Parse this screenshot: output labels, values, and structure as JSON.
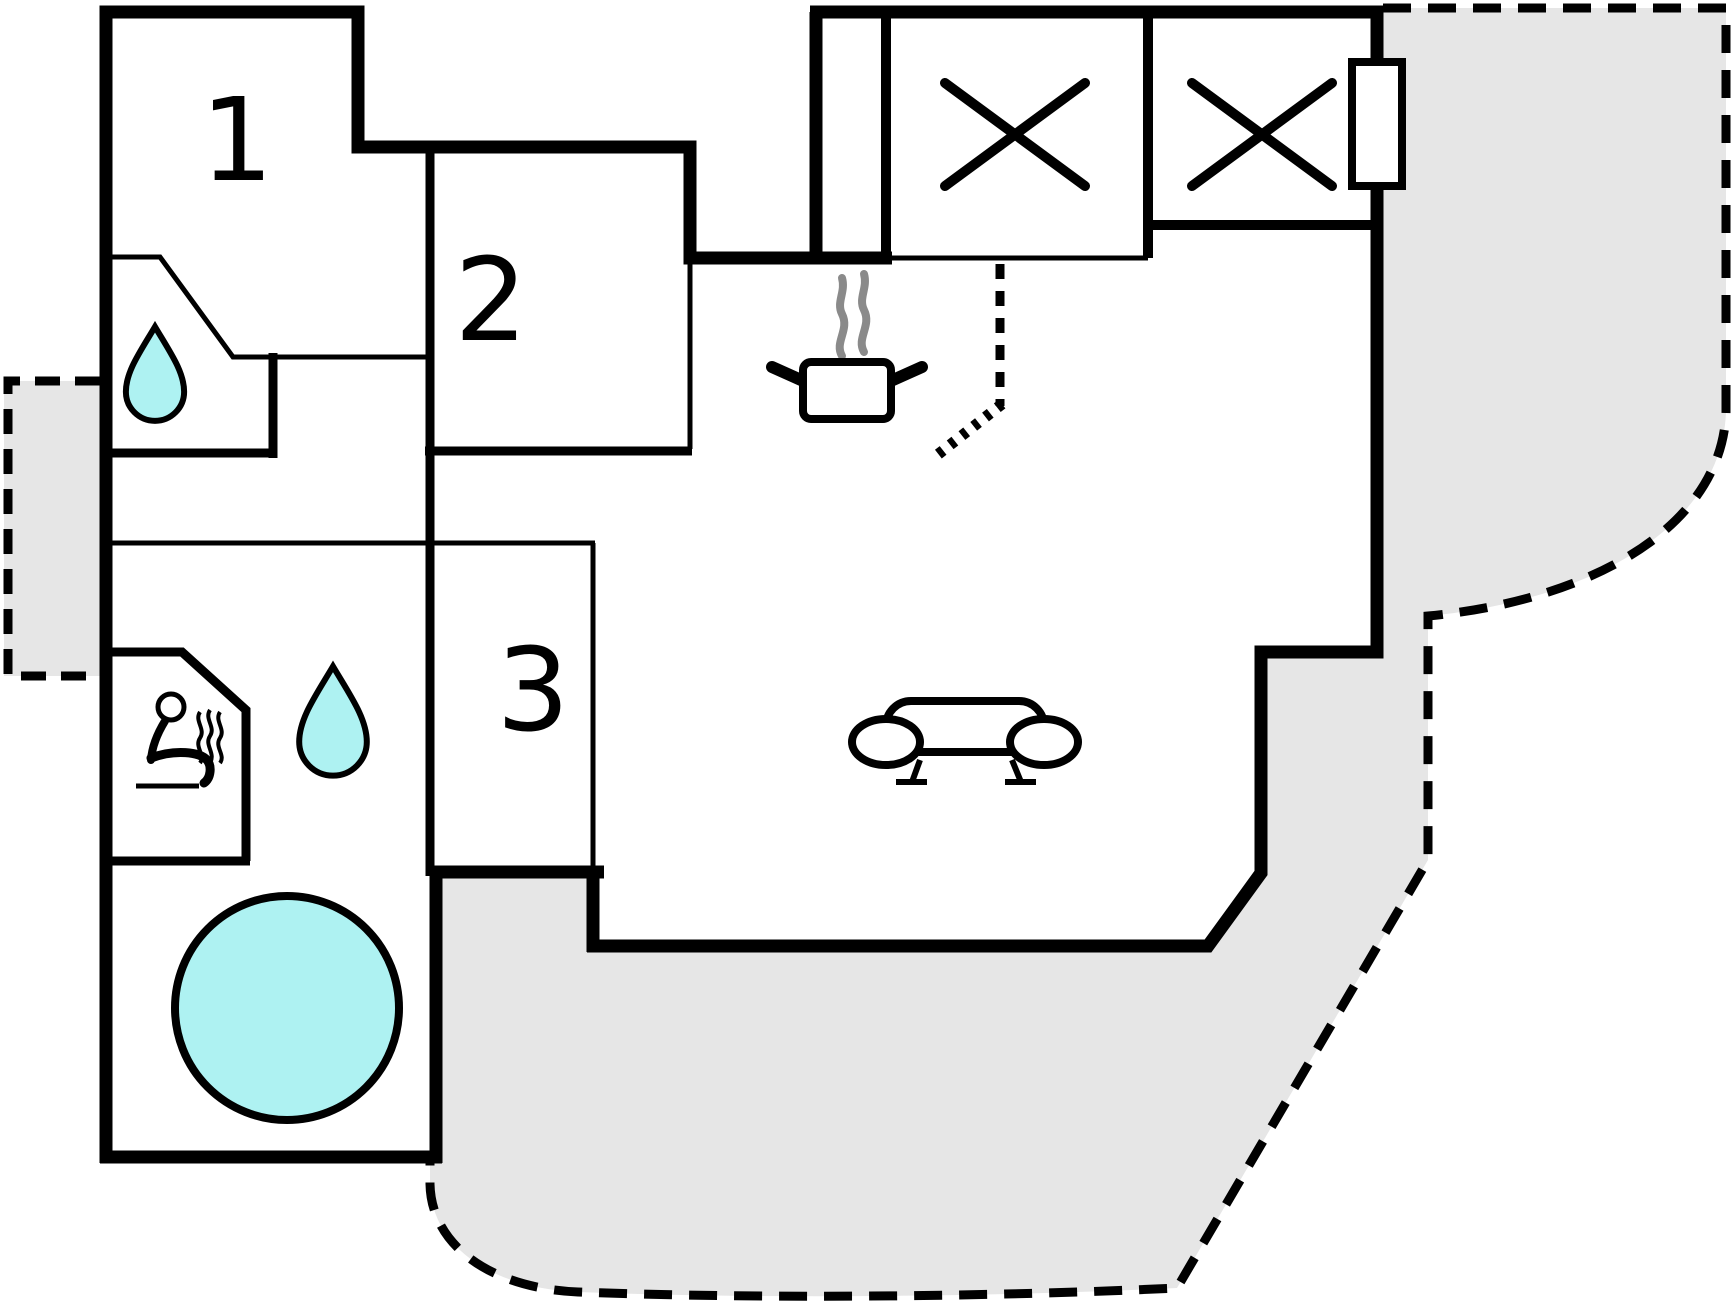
{
  "page": {
    "type": "floor-plan",
    "title": "Holiday home floor plan"
  },
  "rooms": [
    {
      "name": "room-1",
      "label": "1"
    },
    {
      "name": "room-2",
      "label": "2"
    },
    {
      "name": "room-3",
      "label": "3"
    }
  ],
  "symbols": {
    "bathroom_drop": "water-drop",
    "wellness_drop": "water-drop",
    "sauna": "person-on-sauna-bench-with-steam",
    "hot_tub": "round-hot-tub",
    "stove": "cooking-pot-with-steam",
    "sofa": "sofa",
    "closet_left": "x-cross",
    "closet_right": "x-cross",
    "window": "window-on-wall",
    "terrace_main": "dashed-terrace",
    "terrace_left": "dashed-terrace"
  },
  "colors": {
    "walls": "#000000",
    "water_fill": "#aef2f2",
    "terrace_fill": "#e6e6e6",
    "steam_gray": "#8a8a8a",
    "background": "#ffffff"
  }
}
